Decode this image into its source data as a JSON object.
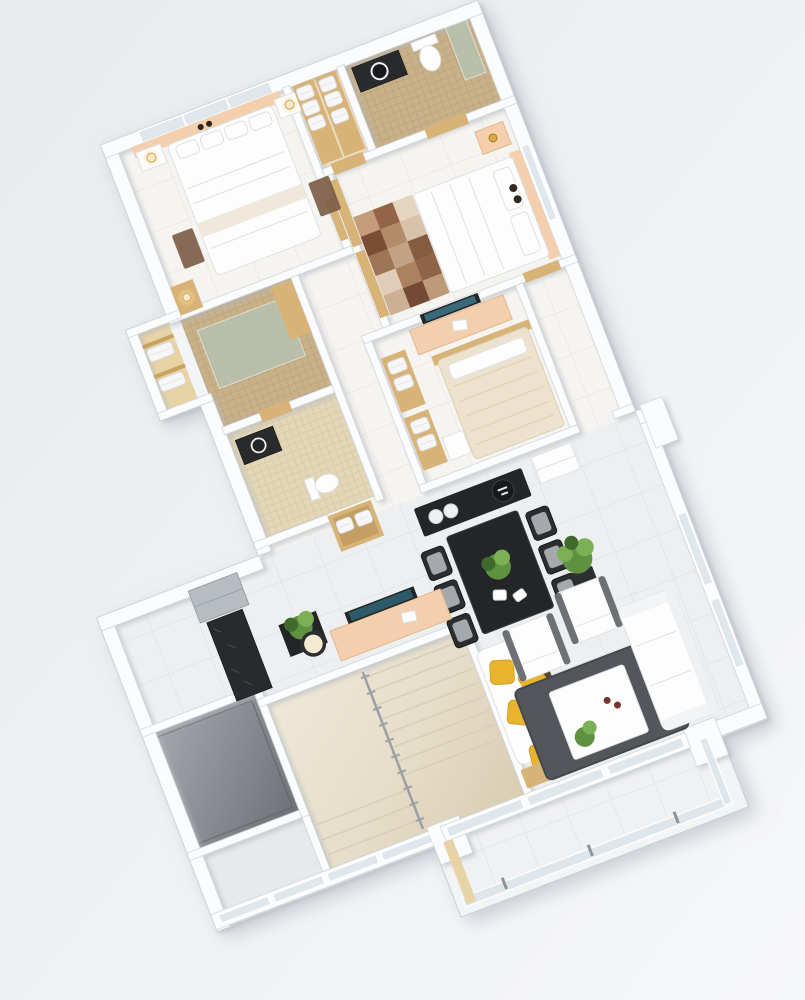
{
  "scene": {
    "kind": "3d-floor-plan-render",
    "view": "isometric top-down, plan rotated about 21 degrees",
    "text_visible": "none",
    "description": "White-walled three-bedroom apartment render with tan mosaic bathrooms, wooden doors, marble staircase, elevator shaft, dining and living zones, and a glass-railed balcony"
  },
  "palette": {
    "bg1": "#e8eaed",
    "bg2": "#f6f7f9",
    "wall": "#fbfcfd",
    "wallEdge": "#ccd1d7",
    "floorWarm": "#f6f4f0",
    "floorCool": "#edeff1",
    "mosaic": "#c8b189",
    "mosaicLight": "#e3d7b8",
    "wood": "#d8b377",
    "woodLight": "#e8d3a5",
    "peach": "#f3cfad",
    "black": "#232527",
    "cushion": "#b3b7bb",
    "rug": "#53565a",
    "yellow": "#e8b42e",
    "marble1": "#efe8d8",
    "marble2": "#ded3ba",
    "metal": "#9aa0a6",
    "glass": "#dde5eb",
    "glassGreen": "#b5c4b4",
    "shaft1": "#9ea2a6",
    "shaft2": "#717679",
    "cream": "#ece2cd",
    "furnEdge": "#dfe1e4",
    "green": "#5e9140",
    "green2": "#7cb055",
    "gold": "#d9a74a",
    "glow": "#f9dfa0",
    "sideRug": "#7b5b44"
  },
  "counts": {
    "stair_treads_main": 8,
    "stair_treads_lower": 3,
    "railing_balusters": 10,
    "balcony_rail_posts": 3,
    "balcony_door_panes": 3,
    "entry_glass_panes": 4,
    "dining_chairs_per_side": 3,
    "yellow_pillows": 5,
    "rug_patch_cols": 3,
    "rug_patch_rows": 5,
    "towel_stacks_top_closet": 6,
    "towel_stacks_left_closet": 2,
    "towel_stacks_bedroom3": 4,
    "linen_stacks_hall_niche": 2
  },
  "rooms": [
    {
      "name": "bedroom-1",
      "furniture": [
        "double-bed-white",
        "two-nightstands-with-lamps",
        "window",
        "peach-accent-wall",
        "side-rugs",
        "lamp-shelf"
      ]
    },
    {
      "name": "linen-closet-top",
      "furniture": [
        "wood-shelves",
        "towel-stacks"
      ]
    },
    {
      "name": "bathroom-1",
      "furniture": [
        "dark-vanity-round-sink",
        "toilet",
        "glass-shower",
        "mosaic-tile-walls"
      ]
    },
    {
      "name": "master-bedroom",
      "furniture": [
        "double-bed-white",
        "peach-headboard",
        "patchwork-rug",
        "nightstand-gold-lamp",
        "wardrobe-doors"
      ]
    },
    {
      "name": "bedroom-3",
      "furniture": [
        "bed-cream",
        "tv",
        "peach-tv-console",
        "towel-shelves",
        "white-nightstand"
      ]
    },
    {
      "name": "bathroom-2",
      "furniture": [
        "glass-floor-shower",
        "wood-cabinet",
        "mosaic-tile-walls"
      ]
    },
    {
      "name": "bathroom-3",
      "furniture": [
        "dark-vanity",
        "toilet",
        "linen-niche"
      ]
    },
    {
      "name": "left-closet",
      "furniture": [
        "towel-stacks",
        "warm-lamp"
      ]
    },
    {
      "name": "kitchen",
      "furniture": [
        "steel-unit",
        "black-granite-counter"
      ]
    },
    {
      "name": "dining",
      "furniture": [
        "black-dining-table",
        "six-chairs",
        "black-sideboard",
        "decor-spheres",
        "plant-centerpiece",
        "tall-plant",
        "white-drawer-cabinet",
        "black-plant-stand"
      ]
    },
    {
      "name": "living",
      "furniture": [
        "white-sofa",
        "two-white-armchairs",
        "gray-shag-rug",
        "white-coffee-table",
        "tv",
        "peach-tv-console",
        "ring-floor-lamp",
        "yellow-pillow-chaise",
        "wood-side-table"
      ]
    },
    {
      "name": "staircase",
      "furniture": [
        "marble-steps",
        "metal-railing"
      ]
    },
    {
      "name": "elevator-shaft",
      "furniture": []
    },
    {
      "name": "balcony",
      "furniture": [
        "glass-sliding-doors",
        "glass-railing",
        "wood-strip"
      ]
    },
    {
      "name": "entry",
      "furniture": [
        "frosted-glass-wall"
      ]
    }
  ]
}
